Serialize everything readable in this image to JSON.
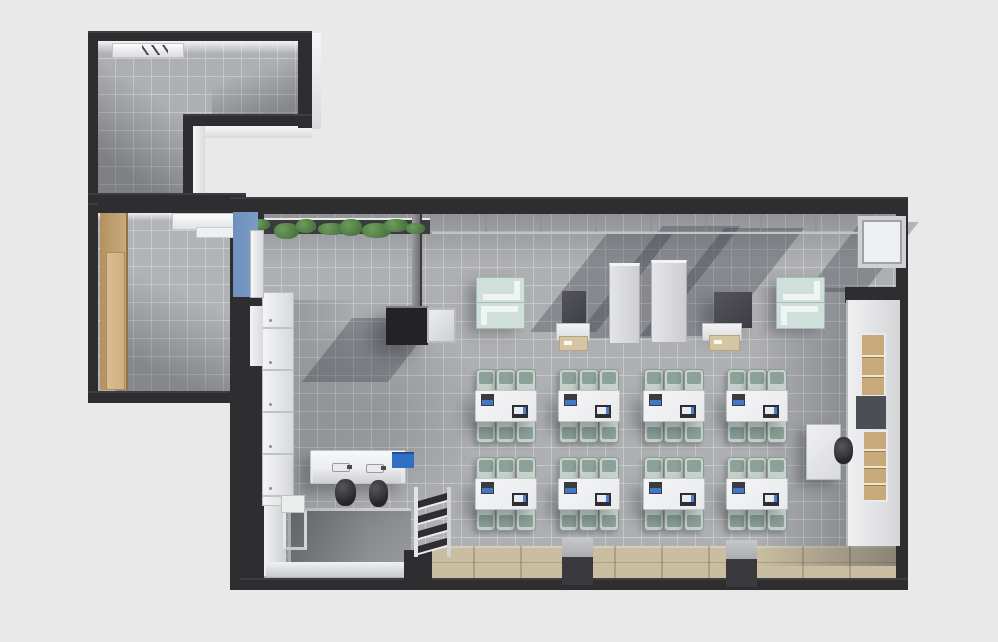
{
  "scene": {
    "type": "3d-floor-plan-render",
    "description": "Top-down 3D architectural render of an L-shaped office/classroom suite: a utility room (top-left), a side room with wardrobe (left), and a large classroom with desk clusters, lecterns, cabinets, sofas and a sink station.",
    "width_px": 998,
    "height_px": 642
  },
  "palette": {
    "background": "#e9e9e9",
    "wall": "#2e2e31",
    "floor": "#aeafb2",
    "wood_floor": "#cabea2",
    "wood_cabinet": "#c8a97a",
    "accent_blue_wall": "#7b9cc6",
    "accent_blue_panel": "#2f6fc4",
    "plant_green": "#4a7842",
    "mint_sofa": "#cfdfd9",
    "chair_back": "#c6d2cc",
    "chair_seat": "#8ca198",
    "table_top": "#e9eaec",
    "beige": "#d6c5a2",
    "screen_blue": "#3f77c9"
  },
  "rooms": [
    {
      "id": "utility-room",
      "label": "utility room (top-left, L-shaped)"
    },
    {
      "id": "side-room",
      "label": "side room with wardrobe (left)"
    },
    {
      "id": "classroom",
      "label": "main classroom / open office"
    }
  ],
  "desk_grid": {
    "columns_x": [
      475,
      558,
      643,
      726
    ],
    "rows_y": [
      390,
      478
    ],
    "table_width": 60,
    "table_height": 30,
    "chairs_per_side": 3,
    "chair_width": 18,
    "chair_spacing": 20,
    "items_per_table": [
      "laptop",
      "tablet-device"
    ]
  },
  "planter": {
    "x": 252,
    "y": 219,
    "width": 176,
    "clumps": 8
  },
  "pillars": [
    {
      "x": 562,
      "y": 538
    },
    {
      "x": 726,
      "y": 540
    }
  ],
  "ladder_rack": {
    "slats": 4,
    "slat_offsets": [
      10,
      25,
      40,
      55
    ]
  },
  "lockers": {
    "drawers": 5,
    "section_height": 42
  },
  "shelf_cubbies": {
    "upper_rows": 3,
    "lower_rows": 4
  }
}
